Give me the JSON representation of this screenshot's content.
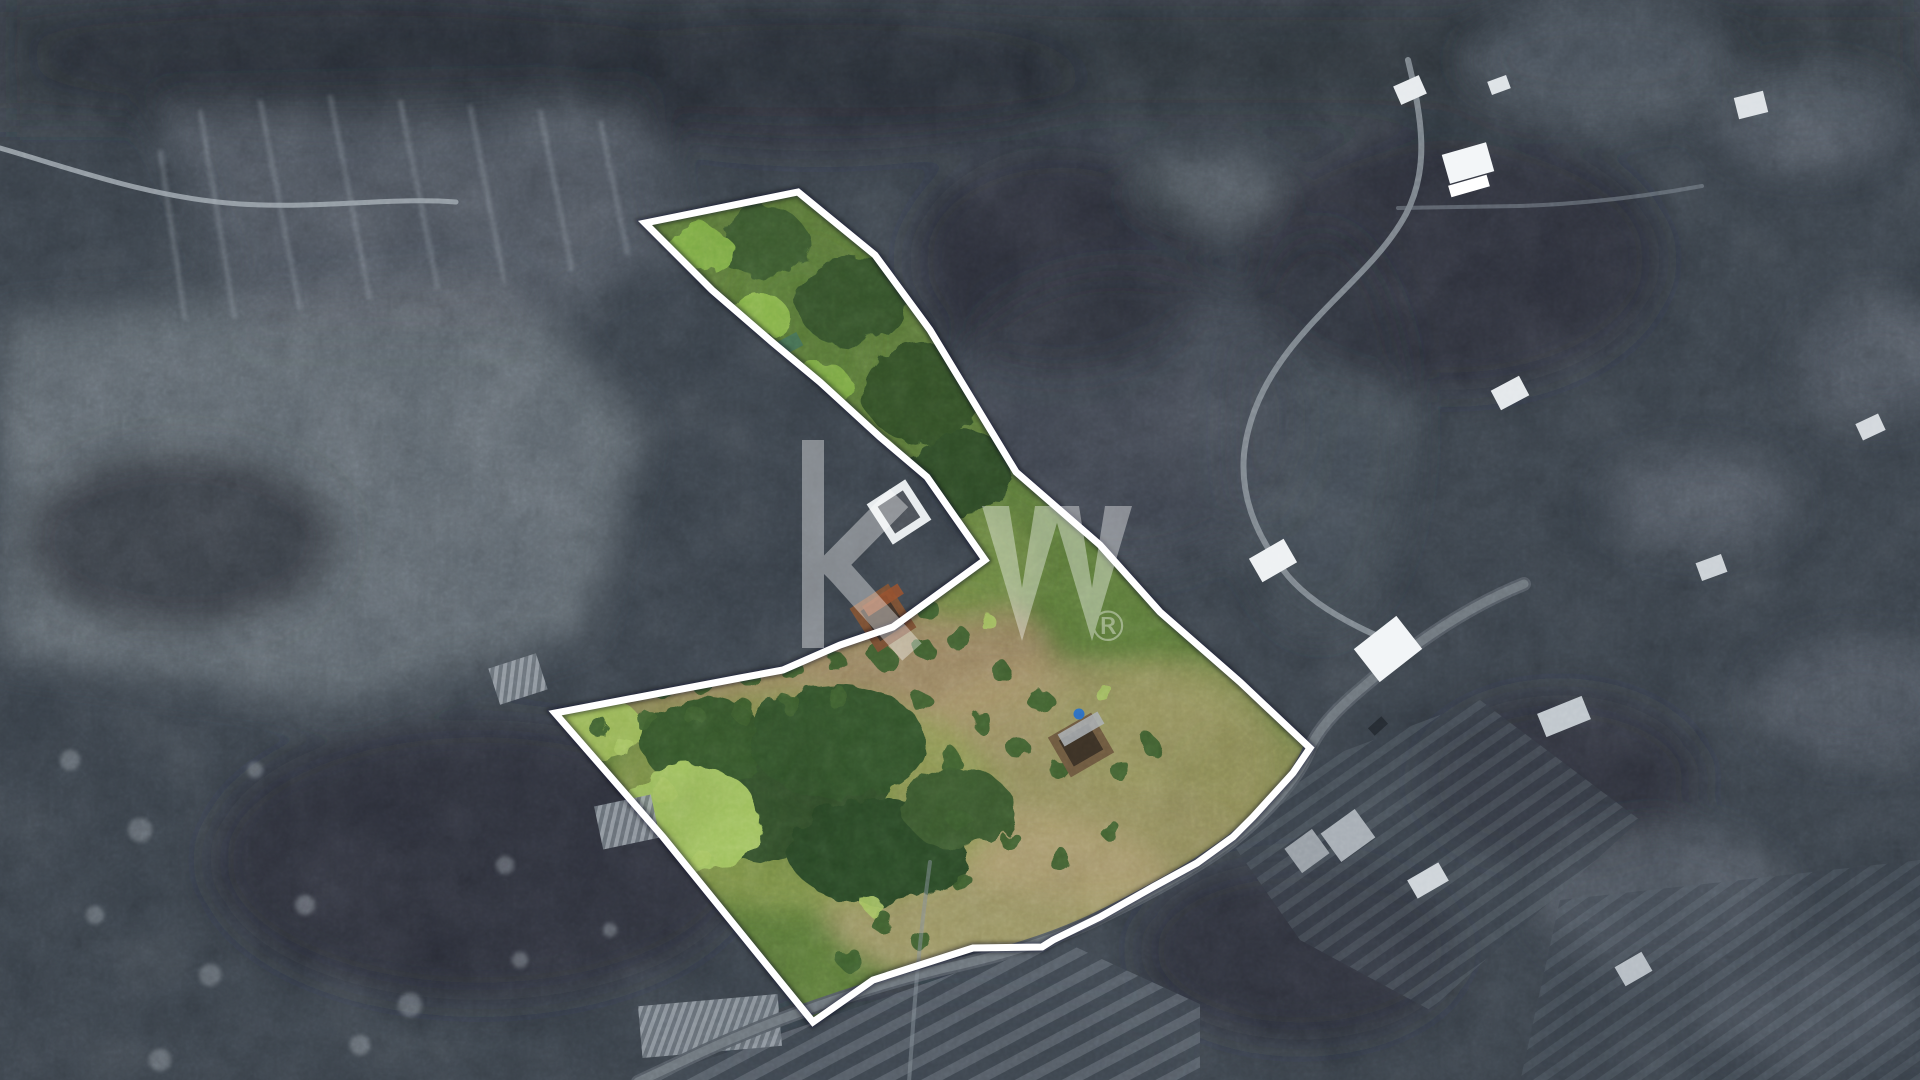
{
  "watermark": {
    "logo_text": "kw",
    "registered_symbol": "®",
    "color": "#ffffff",
    "opacity": 0.38
  },
  "overlay": {
    "boundary_color": "#ffffff",
    "boundary_width": 7,
    "parcel_outline": [
      [
        645,
        223
      ],
      [
        798,
        192
      ],
      [
        875,
        255
      ],
      [
        930,
        330
      ],
      [
        1016,
        472
      ],
      [
        1100,
        545
      ],
      [
        1160,
        612
      ],
      [
        1240,
        682
      ],
      [
        1310,
        748
      ],
      [
        1293,
        773
      ],
      [
        1253,
        817
      ],
      [
        1233,
        837
      ],
      [
        1197,
        863
      ],
      [
        1153,
        887
      ],
      [
        1100,
        917
      ],
      [
        1053,
        940
      ],
      [
        1042,
        947
      ],
      [
        973,
        948
      ],
      [
        873,
        980
      ],
      [
        813,
        1022
      ],
      [
        663,
        837
      ],
      [
        555,
        713
      ],
      [
        740,
        678
      ],
      [
        783,
        670
      ],
      [
        840,
        645
      ],
      [
        893,
        627
      ],
      [
        985,
        560
      ],
      [
        927,
        477
      ],
      [
        880,
        437
      ],
      [
        820,
        382
      ],
      [
        772,
        342
      ],
      [
        712,
        290
      ]
    ]
  },
  "scene": {
    "palette": {
      "background_gray": "#3a424b",
      "forest_dark": "#242b32",
      "scrub_light": "#6b747c",
      "road_light": "#9aa3ab",
      "asphalt": "#5c646c",
      "parcel_green": "#5d7c3a",
      "parcel_lime": "#82b246",
      "parcel_tan": "#ab9a6c",
      "soil_brown": "#a58a66",
      "bush_dark": "#33522a",
      "ruin_wall": "#7a5034",
      "water_tank_blue": "#2e6fc0"
    },
    "roads": [
      {
        "name": "road-top-left",
        "d": "M0,148 C70,168 150,198 240,204 C320,209 392,197 456,202",
        "color": "#9aa3ab",
        "width": 5,
        "opacity": 0.9
      },
      {
        "name": "road-village-upper",
        "d": "M1408,60 C1422,118 1430,168 1406,214 C1383,257 1340,291 1306,330 C1272,368 1249,408 1244,454 C1240,500 1259,541 1288,576 C1312,604 1350,625 1392,642",
        "color": "#8e979f",
        "width": 6,
        "opacity": 0.8
      },
      {
        "name": "road-parcel-access-base",
        "d": "M1524,584 C1464,608 1408,648 1362,688 C1332,713 1318,731 1310,748 C1296,784 1260,818 1232,841 C1196,868 1152,892 1099,918 C1052,941 1000,956 941,969 C860,989 772,1020 702,1052 L638,1082",
        "color": "#565e66",
        "width": 14,
        "opacity": 0.95
      },
      {
        "name": "road-parcel-access-surface",
        "d": "M1524,584 C1464,608 1408,648 1362,688 C1332,713 1318,731 1310,748 C1296,784 1260,818 1232,841 C1196,868 1152,892 1099,918 C1052,941 1000,956 941,969 C860,989 772,1020 702,1052 L638,1082",
        "color": "#727a82",
        "width": 9,
        "opacity": 0.9
      },
      {
        "name": "road-top-right",
        "d": "M1398,208 L1520,206 C1582,204 1642,197 1702,186",
        "color": "#7e8790",
        "width": 4,
        "opacity": 0.55
      },
      {
        "name": "path-bottom-village",
        "d": "M930,862 C922,920 916,980 912,1040 L909,1082",
        "color": "#868f97",
        "width": 4,
        "opacity": 0.5
      }
    ],
    "buildings": [
      {
        "name": "house-north-1",
        "x": 1396,
        "y": 80,
        "w": 28,
        "h": 20,
        "rot": -24,
        "color": "#e7ebee"
      },
      {
        "name": "house-white-villa",
        "x": 1445,
        "y": 148,
        "w": 46,
        "h": 30,
        "rot": -16,
        "color": "#f3f6f8"
      },
      {
        "name": "villa-terrace",
        "x": 1449,
        "y": 180,
        "w": 40,
        "h": 12,
        "rot": -16,
        "color": "#ffffff"
      },
      {
        "name": "house-north-2",
        "x": 1489,
        "y": 78,
        "w": 20,
        "h": 14,
        "rot": -20,
        "color": "#dde2e6"
      },
      {
        "name": "house-mid-east",
        "x": 1494,
        "y": 382,
        "w": 32,
        "h": 22,
        "rot": -28,
        "color": "#e4e8eb"
      },
      {
        "name": "house-white-mid",
        "x": 1253,
        "y": 547,
        "w": 40,
        "h": 27,
        "rot": -30,
        "color": "#eef1f3"
      },
      {
        "name": "house-white-east",
        "x": 1361,
        "y": 628,
        "w": 54,
        "h": 42,
        "rot": -38,
        "color": "#f2f5f7"
      },
      {
        "name": "house-gray-roof",
        "x": 1540,
        "y": 704,
        "w": 48,
        "h": 25,
        "rot": -22,
        "color": "#c0c7cd"
      },
      {
        "name": "house-south-1",
        "x": 1327,
        "y": 818,
        "w": 42,
        "h": 35,
        "rot": -36,
        "color": "#a7aeb5"
      },
      {
        "name": "house-south-2",
        "x": 1290,
        "y": 836,
        "w": 34,
        "h": 30,
        "rot": -36,
        "color": "#99a0a7"
      },
      {
        "name": "house-south-3",
        "x": 1410,
        "y": 870,
        "w": 36,
        "h": 21,
        "rot": -30,
        "color": "#ced4d9"
      },
      {
        "name": "house-far-ne",
        "x": 1736,
        "y": 94,
        "w": 30,
        "h": 22,
        "rot": -14,
        "color": "#dce1e5"
      },
      {
        "name": "house-far-east-1",
        "x": 1858,
        "y": 418,
        "w": 25,
        "h": 18,
        "rot": -25,
        "color": "#d3d8dd"
      },
      {
        "name": "house-far-east-2",
        "x": 1698,
        "y": 558,
        "w": 27,
        "h": 19,
        "rot": -20,
        "color": "#cbd1d6"
      },
      {
        "name": "house-far-se",
        "x": 1618,
        "y": 958,
        "w": 31,
        "h": 22,
        "rot": -30,
        "color": "#b6bdc4"
      },
      {
        "name": "white-ruin-mid",
        "x": 876,
        "y": 488,
        "w": 46,
        "h": 48,
        "rot": -33,
        "color": "#e8ecee"
      },
      {
        "name": "green-shed-strip",
        "x": 780,
        "y": 336,
        "w": 21,
        "h": 15,
        "rot": -28,
        "color": "#477155"
      },
      {
        "name": "ruin-upper-parcel",
        "x": 860,
        "y": 592,
        "w": 46,
        "h": 52,
        "rot": -33,
        "color": "#7a5034"
      },
      {
        "name": "ruin-lower-parcel",
        "x": 1056,
        "y": 722,
        "w": 50,
        "h": 46,
        "rot": -30,
        "color": "#6e5a40"
      },
      {
        "name": "car-on-road",
        "x": 1369,
        "y": 721,
        "w": 18,
        "h": 10,
        "rot": -42,
        "color": "#262c33"
      }
    ],
    "regions": [
      {
        "id": "highlighted-parcel",
        "description": "Irregular land parcel outlined in white, interior in full colour: upper green strip, orchard field with bush rows, dry tan ground, two ruins, blue water tank"
      },
      {
        "id": "surroundings",
        "description": "Hillside in desaturated grey: dense forest, scrub slopes, cliff face, winding roads, scattered houses, terraced fields"
      },
      {
        "id": "kw-watermark",
        "description": "Semi-transparent white kw® logo over the centre of the photo"
      }
    ]
  }
}
